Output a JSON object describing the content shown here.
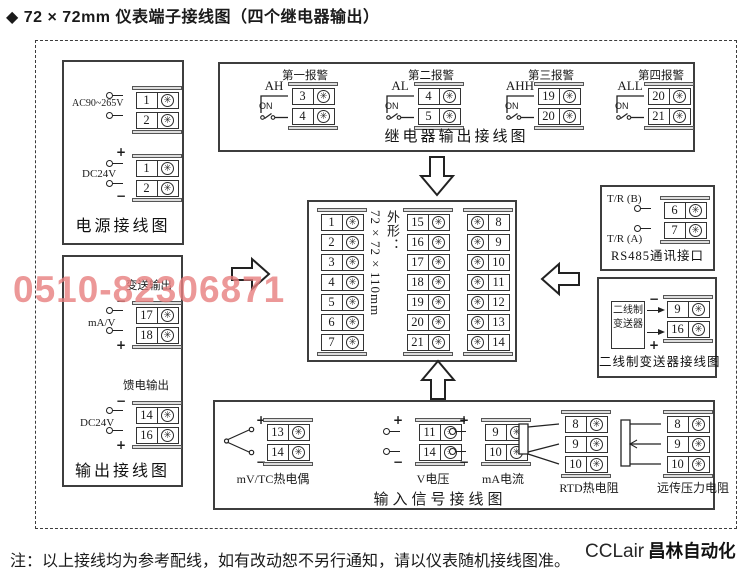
{
  "page_title": "◆ 72 × 72mm 仪表端子接线图（四个继电器输出）",
  "watermark": {
    "text": "0510-82306871",
    "color": "#e87f7f"
  },
  "logo": {
    "prefix": "CCLair",
    "name": "昌林自动化"
  },
  "footnote": "注：以上接线均为参考配线，如有改动恕不另行通知，请以仪表随机接线图准。",
  "symbols": {
    "plus": "+",
    "minus": "−",
    "on": "ON"
  },
  "icons": {
    "screw": "✳"
  },
  "power_box": {
    "title": "电源接线图",
    "ac": {
      "label": "AC90~265V",
      "terminals": [
        "1",
        "2"
      ]
    },
    "dc": {
      "label": "DC24V",
      "terminals": [
        "1",
        "2"
      ]
    }
  },
  "output_box": {
    "title": "输出接线图",
    "transmit": {
      "caption": "变送输出",
      "label": "mA/V",
      "terminals": [
        "17",
        "18"
      ]
    },
    "feed": {
      "caption": "馈电输出",
      "label": "DC24V",
      "terminals": [
        "14",
        "16"
      ]
    }
  },
  "relay_box": {
    "title": "继电器输出接线图",
    "alarms": [
      {
        "caption": "第一报警",
        "tag": "AH",
        "terminals": [
          "3",
          "4"
        ]
      },
      {
        "caption": "第二报警",
        "tag": "AL",
        "terminals": [
          "4",
          "5"
        ]
      },
      {
        "caption": "第三报警",
        "tag": "AHH",
        "terminals": [
          "19",
          "20"
        ]
      },
      {
        "caption": "第四报警",
        "tag": "ALL",
        "terminals": [
          "20",
          "21"
        ]
      }
    ]
  },
  "center_box": {
    "dimension_label": "外形：72×72×110mm",
    "left_col": [
      "1",
      "2",
      "3",
      "4",
      "5",
      "6",
      "7"
    ],
    "mid_col": [
      "15",
      "16",
      "17",
      "18",
      "19",
      "20",
      "21"
    ],
    "right_col": [
      "8",
      "9",
      "10",
      "11",
      "12",
      "13",
      "14"
    ]
  },
  "rs485_box": {
    "title": "RS485通讯接口",
    "line_b": "T/R (B)",
    "line_a": "T/R (A)",
    "terminals": [
      "6",
      "7"
    ]
  },
  "twowire_box": {
    "title": "二线制变送器接线图",
    "device": "二线制变送器",
    "terminals": [
      "9",
      "16"
    ]
  },
  "input_box": {
    "title": "输入信号接线图",
    "tc": {
      "caption": "mV/TC热电偶",
      "terminals": [
        "13",
        "14"
      ]
    },
    "volt": {
      "caption": "V电压",
      "terminals": [
        "11",
        "14"
      ]
    },
    "ma": {
      "caption": "mA电流",
      "terminals": [
        "9",
        "10"
      ]
    },
    "rtd": {
      "caption": "RTD热电阻",
      "terminals": [
        "8",
        "9",
        "10"
      ]
    },
    "pressure": {
      "caption": "远传压力电阻",
      "terminals": [
        "8",
        "9",
        "10"
      ]
    }
  }
}
